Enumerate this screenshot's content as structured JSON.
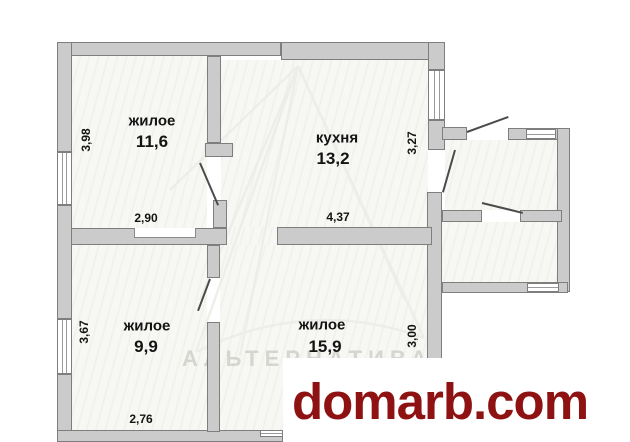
{
  "rooms": {
    "living_top": {
      "name": "жилое",
      "area": "11,6",
      "dim_left": "3,98",
      "dim_bottom": "2,90"
    },
    "kitchen": {
      "name": "кухня",
      "area": "13,2",
      "dim_right": "3,27",
      "dim_bottom": "4,37"
    },
    "living_left": {
      "name": "жилое",
      "area": "9,9",
      "dim_left": "3,67",
      "dim_bottom": "2,76"
    },
    "living_right": {
      "name": "жилое",
      "area": "15,9",
      "dim_right": "3,00"
    }
  },
  "watermarks": {
    "agency": "АЛЬТЕРНАТИВА",
    "site": "domarb.com"
  },
  "colors": {
    "wall_fill": "#cbcbcb",
    "wall_edge": "#7e7e7e",
    "door_line": "#4b4b4b",
    "site_red": "#8e1212",
    "watermark_gray": "#bbbbb5"
  }
}
